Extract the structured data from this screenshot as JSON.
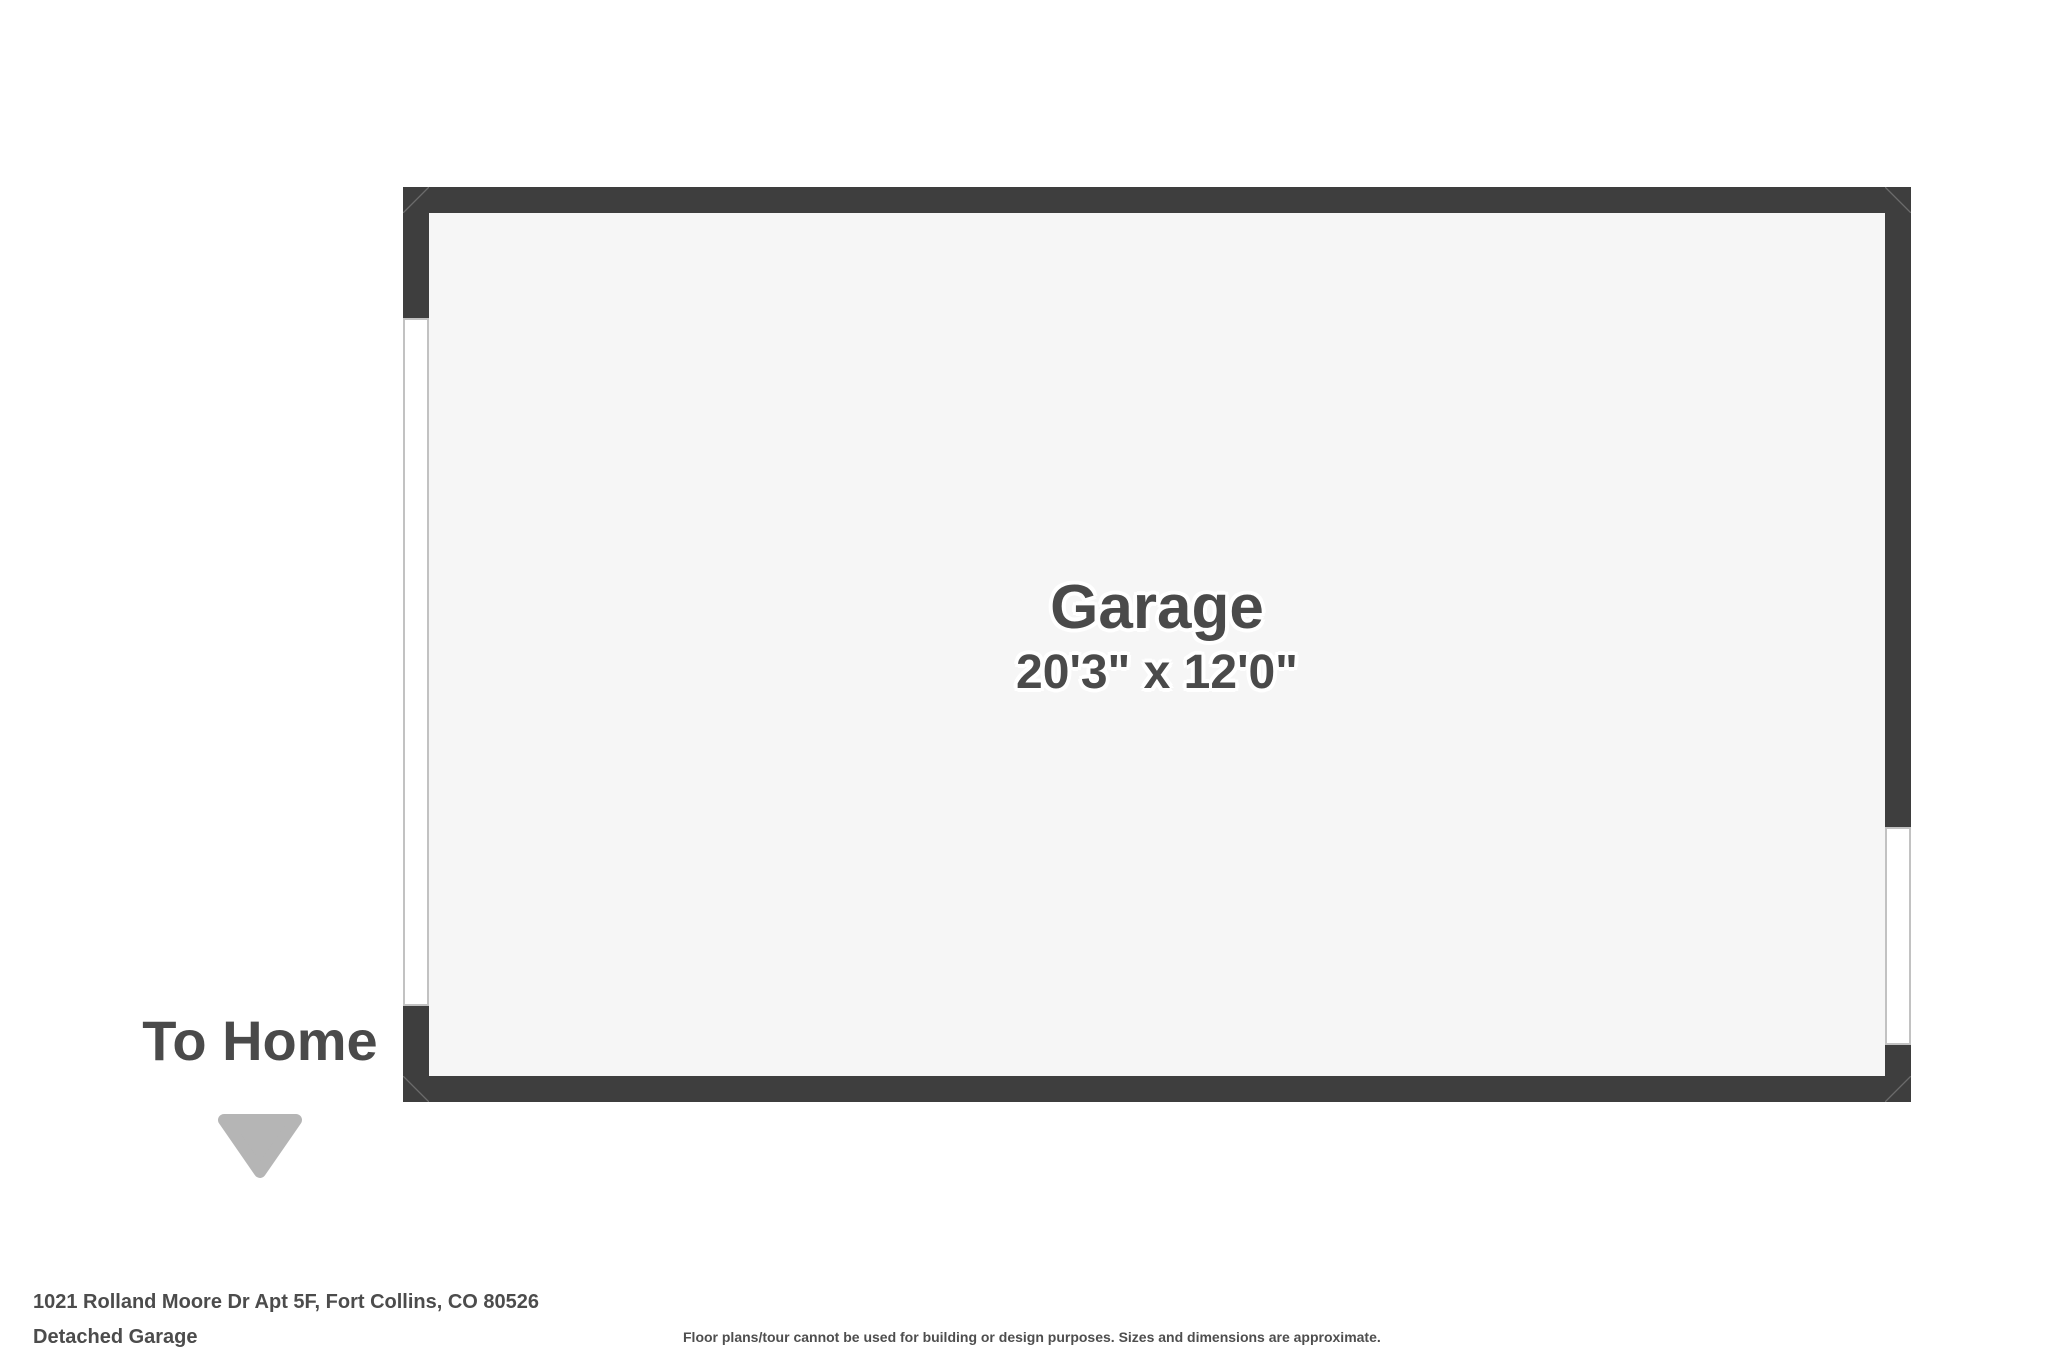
{
  "room": {
    "name": "Garage",
    "dimensions": "20'3\" x 12'0\""
  },
  "annotation": {
    "to_home": "To Home",
    "arrow_icon": "triangle-down"
  },
  "footer": {
    "address": "1021 Rolland Moore Dr Apt 5F, Fort Collins, CO 80526",
    "plan_type": "Detached Garage",
    "disclaimer": "Floor plans/tour cannot be used for building or design purposes. Sizes and dimensions are approximate."
  },
  "colors": {
    "wall": "#3e3e3e",
    "floor": "#f6f6f6",
    "opening_fill": "#ffffff",
    "opening_stroke": "#c2c2c2",
    "label_text": "#4a4a4a",
    "footer_text": "#4c4c4c",
    "arrow": "#b5b5b5",
    "background": "#ffffff"
  }
}
